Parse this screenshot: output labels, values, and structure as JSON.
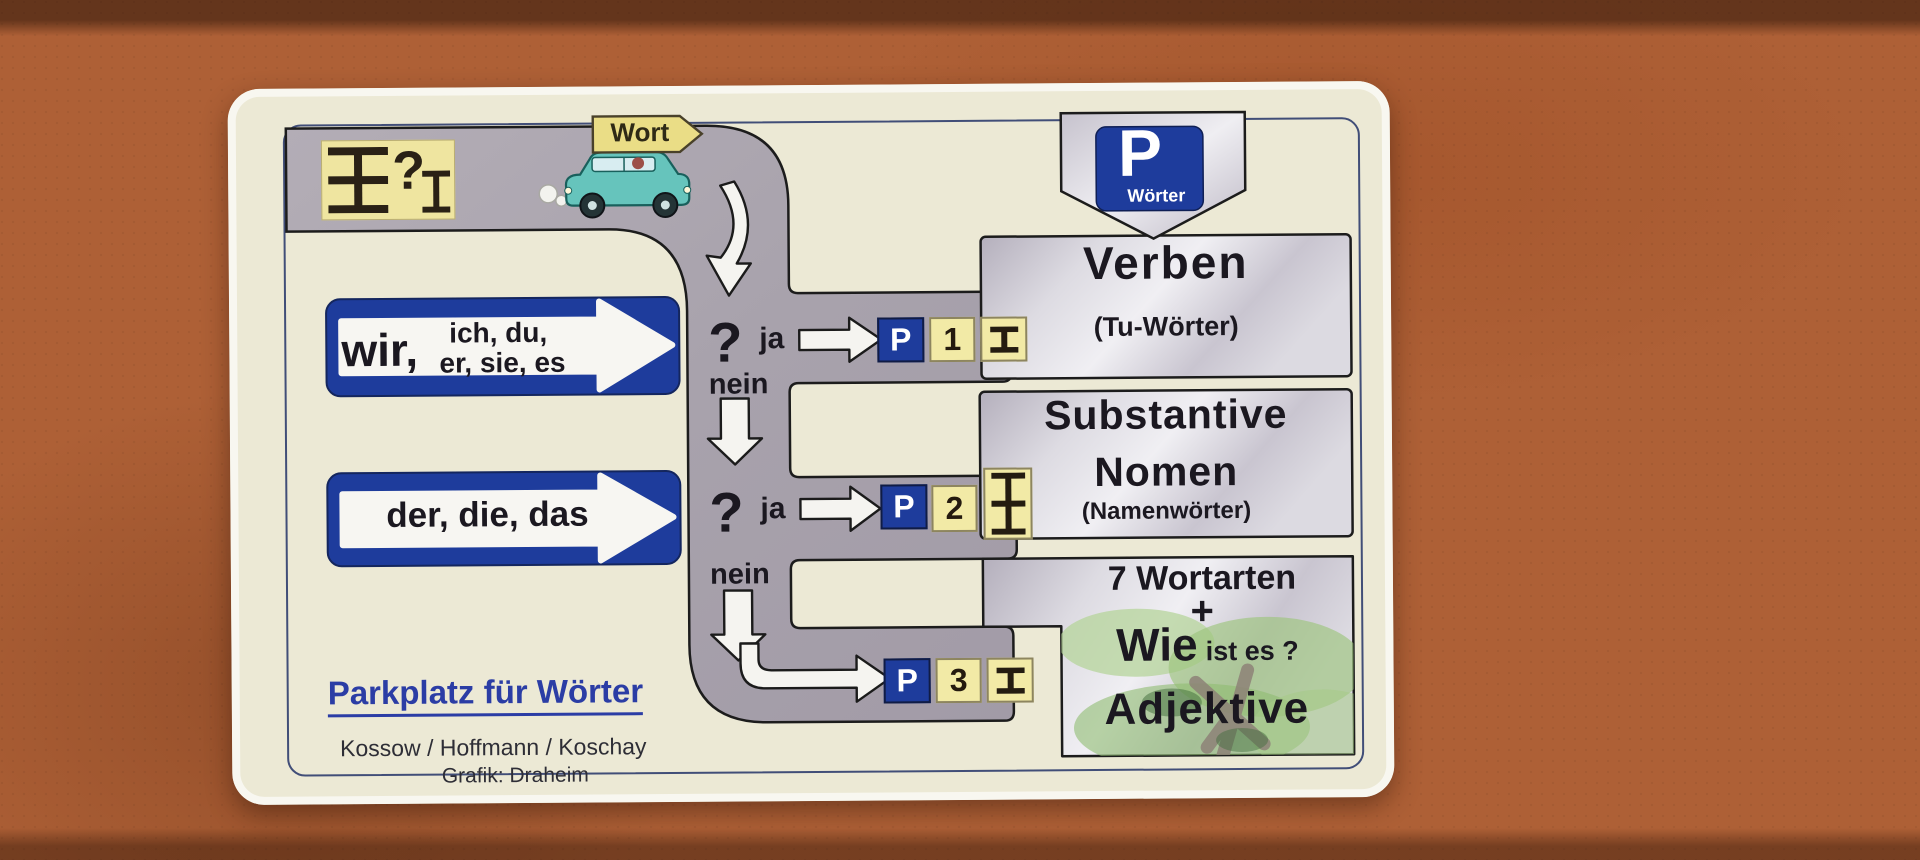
{
  "colors": {
    "background_cork": "#ae6036",
    "card_cream": "#ece9d5",
    "road_gray": "#a8a2ac",
    "box_silver": "#dedce3",
    "accent_blue": "#1e3c9c",
    "square_yellow": "#f2eaa6",
    "title_blue": "#2b3da5"
  },
  "icons": {
    "noun_symbol": "ibeam-3bar-icon",
    "verb_symbol": "ibeam-2bar-icon",
    "adjective_symbol": "ibeam-2bar-icon",
    "car": "car-icon",
    "tree": "tree-watercolor",
    "parking_shield": "parking-sign"
  },
  "top": {
    "symbol_question": "?",
    "car_sign": "Wort"
  },
  "parking_sign": {
    "letter": "P",
    "label": "Wörter"
  },
  "inputs": {
    "pronouns": {
      "main": "wir,",
      "line1": "ich, du,",
      "line2": "er, sie, es"
    },
    "articles": {
      "text": "der, die, das"
    }
  },
  "questions": {
    "q1": {
      "mark": "?",
      "yes": "ja",
      "no": "nein"
    },
    "q2": {
      "mark": "?",
      "yes": "ja",
      "no": "nein"
    }
  },
  "parking": {
    "p1": {
      "letter": "P",
      "number": "1"
    },
    "p2": {
      "letter": "P",
      "number": "2"
    },
    "p3": {
      "letter": "P",
      "number": "3"
    }
  },
  "categories": {
    "verbs": {
      "title": "Verben",
      "subtitle": "(Tu-Wörter)"
    },
    "nouns": {
      "title1": "Substantive",
      "title2": "Nomen",
      "subtitle": "(Namenwörter)"
    },
    "adjectives": {
      "line1": "7 Wortarten",
      "plus": "+",
      "wie": "Wie",
      "rest": "ist es ?",
      "title": "Adjektive"
    }
  },
  "footer": {
    "title": "Parkplatz für Wörter",
    "authors": "Kossow / Hoffmann / Koschay",
    "credit": "Grafik: Draheim"
  }
}
